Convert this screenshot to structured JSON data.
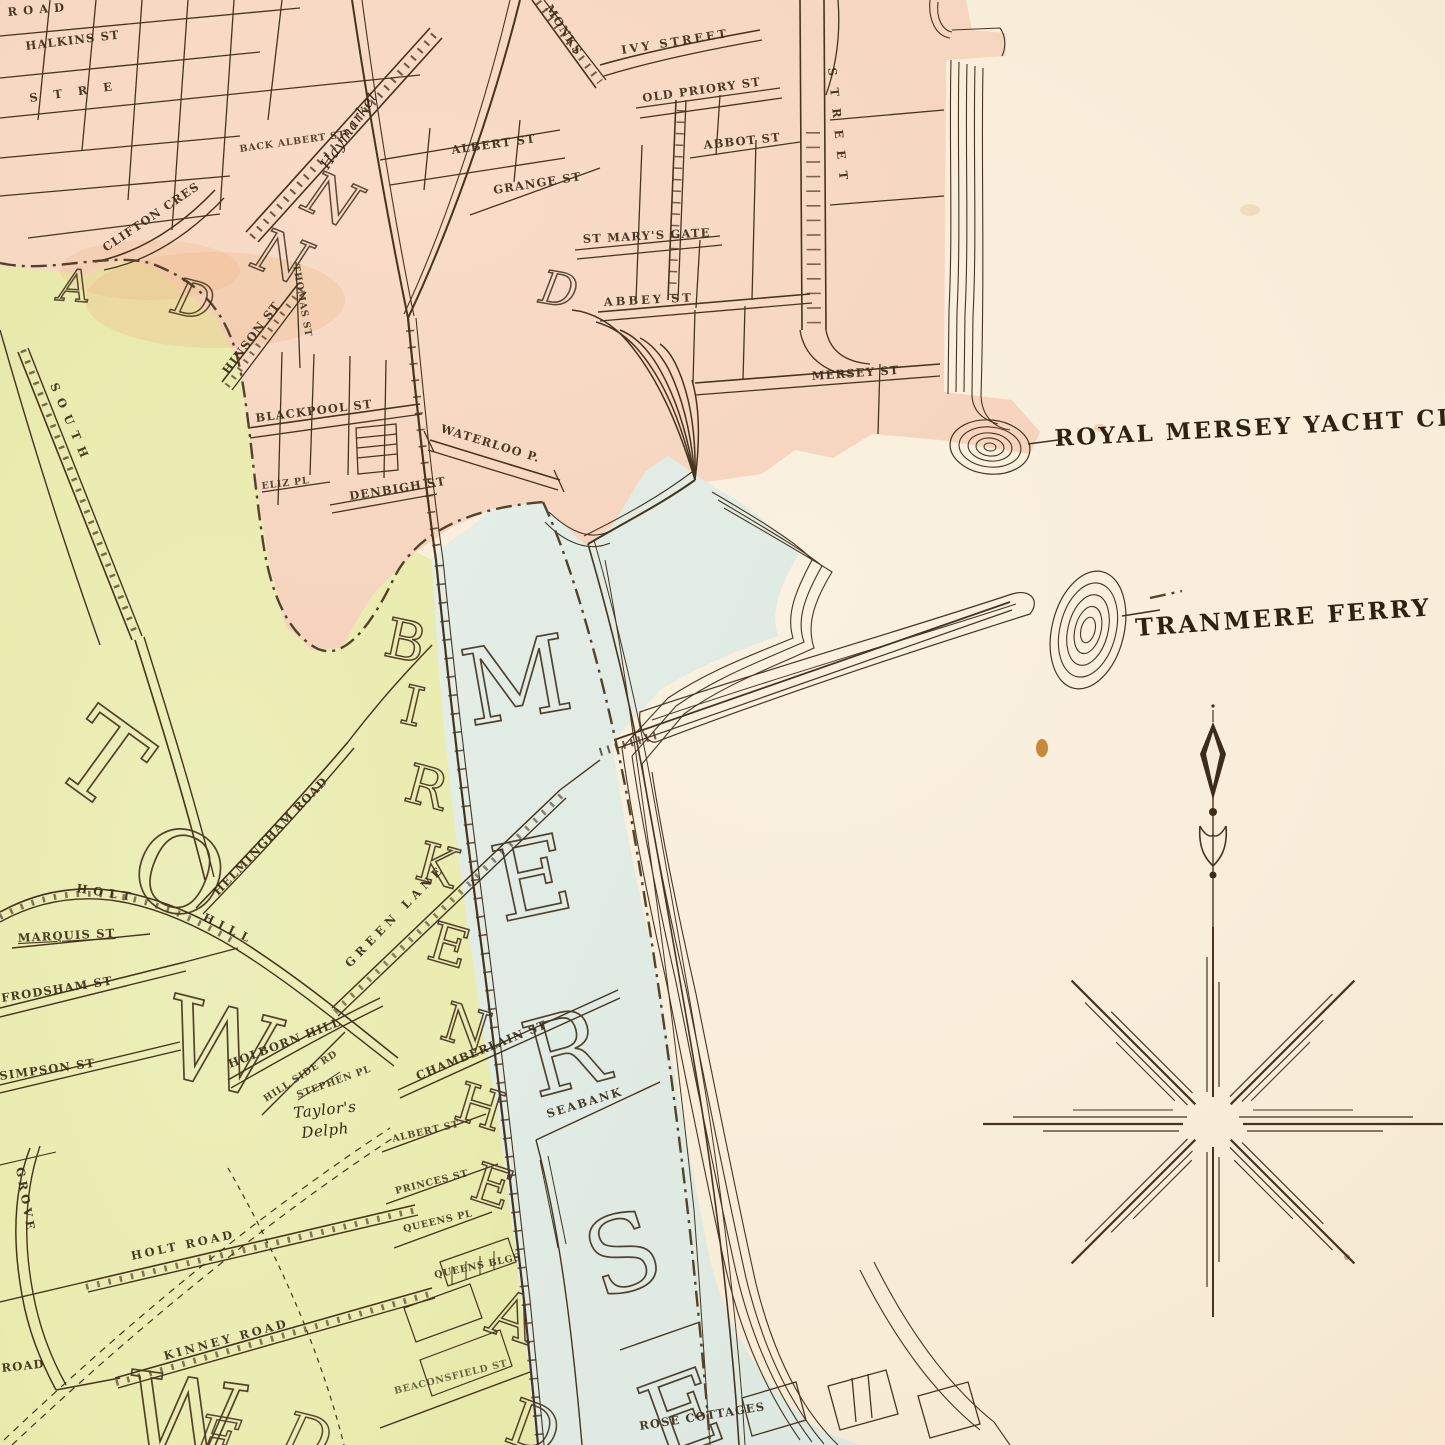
{
  "map": {
    "water_labels": [
      {
        "name": "yacht-club",
        "text": "ROYAL MERSEY YACHT CLUB"
      },
      {
        "name": "tranmere-ferry",
        "text": "TRANMERE FERRY"
      }
    ],
    "pink_streets": [
      "ROAD",
      "HALKINS ST",
      "STRE",
      "CLIFTON CRES",
      "BACK ALBERT ST",
      "ALBERT ST",
      "GRANGE ST",
      "MONKS",
      "IVY STREET",
      "OLD PRIORY ST",
      "ABBOT ST",
      "ST MARY'S GATE",
      "ABBEY ST",
      "MERSEY ST",
      "STREET",
      "HINSON ST",
      "THOMAS ST",
      "BLACKPOOL ST",
      "WATERLOO P.",
      "DENBIGH ST",
      "ELIZ PL"
    ],
    "green_streets": [
      "SOUTH",
      "HELMINGHAM ROAD",
      "MARQUIS ST",
      "HOLT",
      "HILL",
      "FRODSHAM ST",
      "SIMPSON ST",
      "HOLBORN HILL",
      "HILL SIDE RD",
      "STEPHEN PL",
      "HOLT ROAD",
      "KINNEY ROAD",
      "GROVE",
      "ROAD",
      "GREEN LANE",
      "CHAMBERLAIN ST",
      "SEABANK",
      "ALBERT ST",
      "PRINCES ST",
      "QUEENS PL",
      "QUEENS BLGS",
      "BEACONSFIELD ST",
      "ROSE COTTAGES"
    ],
    "places": [
      "Haymarket",
      "Taylor's",
      "Delph"
    ],
    "letters": {
      "mersey": [
        "M",
        "E",
        "R",
        "S",
        "E"
      ],
      "railway": [
        "B",
        "I",
        "R",
        "K",
        "E",
        "N",
        "H",
        "E",
        "A",
        "D"
      ],
      "town": [
        "T",
        "O",
        "W"
      ],
      "misc": [
        "N",
        "N",
        "D",
        "A",
        "D",
        "W",
        "E",
        "D"
      ]
    },
    "colors": {
      "urban_pink": "#f6d7c2",
      "suburb_green": "#e9ecb2",
      "foreshore_blue": "#dfe9e2",
      "water_cream": "#f8edd9",
      "ink": "#463420"
    }
  }
}
